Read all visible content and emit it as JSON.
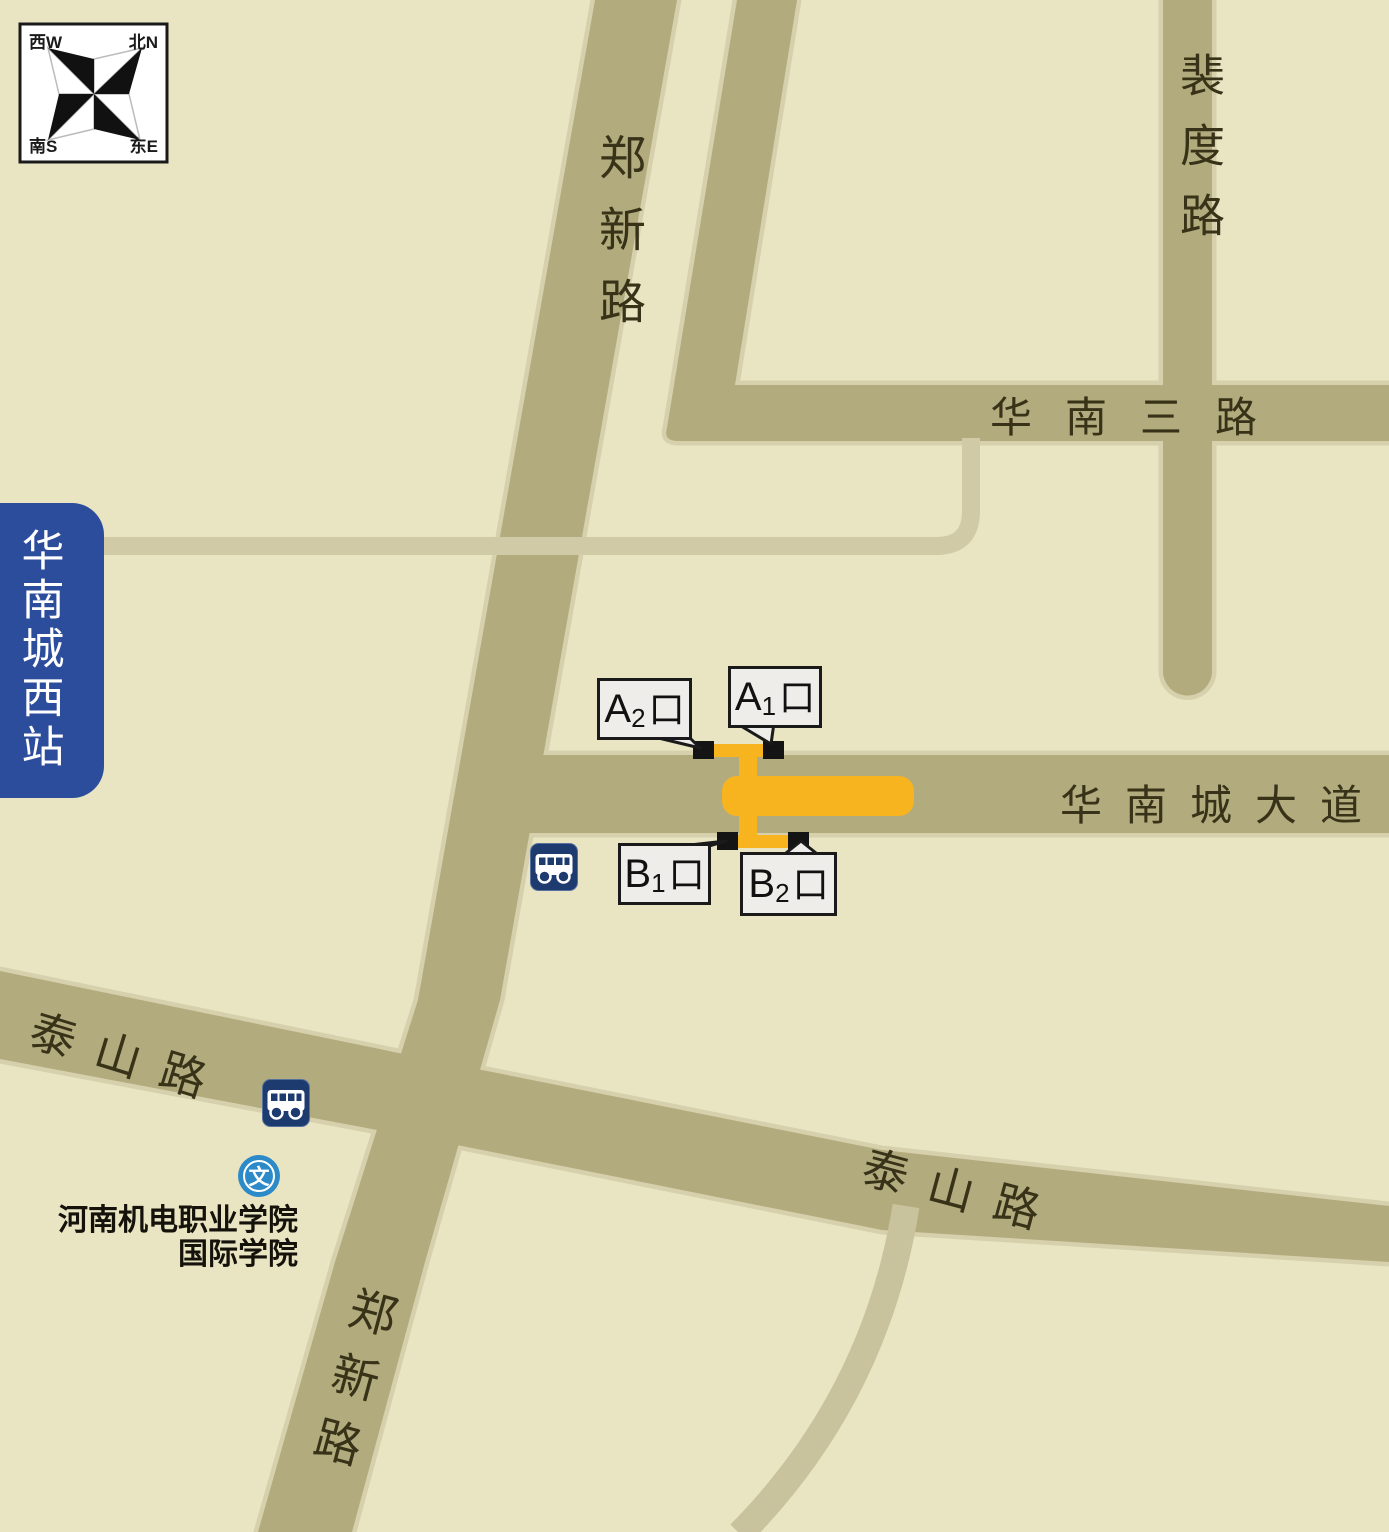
{
  "compass": {
    "nw": "西W",
    "ne": "北N",
    "sw": "南S",
    "se": "东E"
  },
  "station": {
    "name": "华南城西站"
  },
  "roads": {
    "zhengxin_top": "郑新路",
    "zhengxin_bottom": "郑新路",
    "peidu": "裴度路",
    "huanansan": "华南三路",
    "avenue": "华南城大道",
    "taishan_left": "泰山路",
    "taishan_right": "泰山路"
  },
  "exits": [
    {
      "id": "A2",
      "letter": "A",
      "sub": "2",
      "suffix": "口"
    },
    {
      "id": "A1",
      "letter": "A",
      "sub": "1",
      "suffix": "口"
    },
    {
      "id": "B1",
      "letter": "B",
      "sub": "1",
      "suffix": "口"
    },
    {
      "id": "B2",
      "letter": "B",
      "sub": "2",
      "suffix": "口"
    }
  ],
  "poi": {
    "college_line1": "河南机电职业学院",
    "college_line2": "国际学院",
    "culture_mark": "文"
  },
  "colors": {
    "background": "#E9E5C3",
    "road": "#B2AB7D",
    "road_casing": "#D6D0AC",
    "thin_road": "#D0CAA6",
    "station_orange": "#F7B41F",
    "exit_black": "#141414",
    "callout_bg": "#EFEDEA",
    "station_sign_blue": "#2C4C9C",
    "bus_navy": "#1E3B70",
    "culture_blue": "#2D8AC9"
  }
}
